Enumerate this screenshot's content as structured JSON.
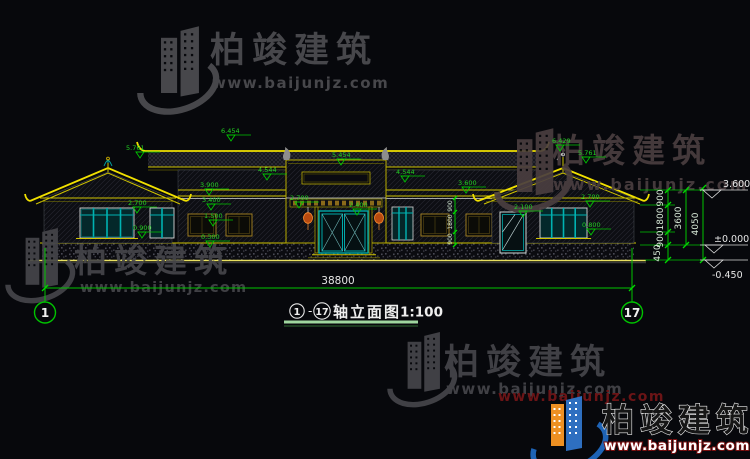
{
  "watermark": {
    "brand": "柏竣建筑",
    "url": "www.baijunjz.com"
  },
  "title": {
    "axis_start": "1",
    "dash": "-",
    "axis_end": "17",
    "text": "轴立面图",
    "scale": "1:100"
  },
  "axes": {
    "left": "1",
    "right": "17"
  },
  "dims": {
    "total": "38800",
    "right_v1": "900",
    "right_v2": "1800",
    "right_v3": "900",
    "right_sum": "3600",
    "right_overall": "4050",
    "right_base": "450",
    "inner_v1": "900",
    "inner_v2": "1800",
    "inner_v3": "900"
  },
  "levels": {
    "eave": "3.600",
    "zero": "±0.000",
    "ground": "-0.450"
  },
  "marks": [
    "5.761",
    "6.454",
    "5.454",
    "4.544",
    "4.544",
    "6.429",
    "5.761",
    "2.700",
    "0.900",
    "3.900",
    "3.400",
    "1.500",
    "0.300",
    "2.700",
    "2.400",
    "3.600",
    "2.100",
    "2.700",
    "0.800"
  ],
  "colors": {
    "background": "#07080c",
    "cad_yellow": "#f0e000",
    "cad_green": "#00c800",
    "window_teal": "#00b2b2",
    "watermark_gray": "#47474b",
    "lantern_orange": "#c85414",
    "logo_blue": "#2e6fc0",
    "logo_orange": "#ee9022",
    "brand_dark_red": "#6b1416"
  },
  "drawing_type": "front elevation, single-story chinese style building"
}
